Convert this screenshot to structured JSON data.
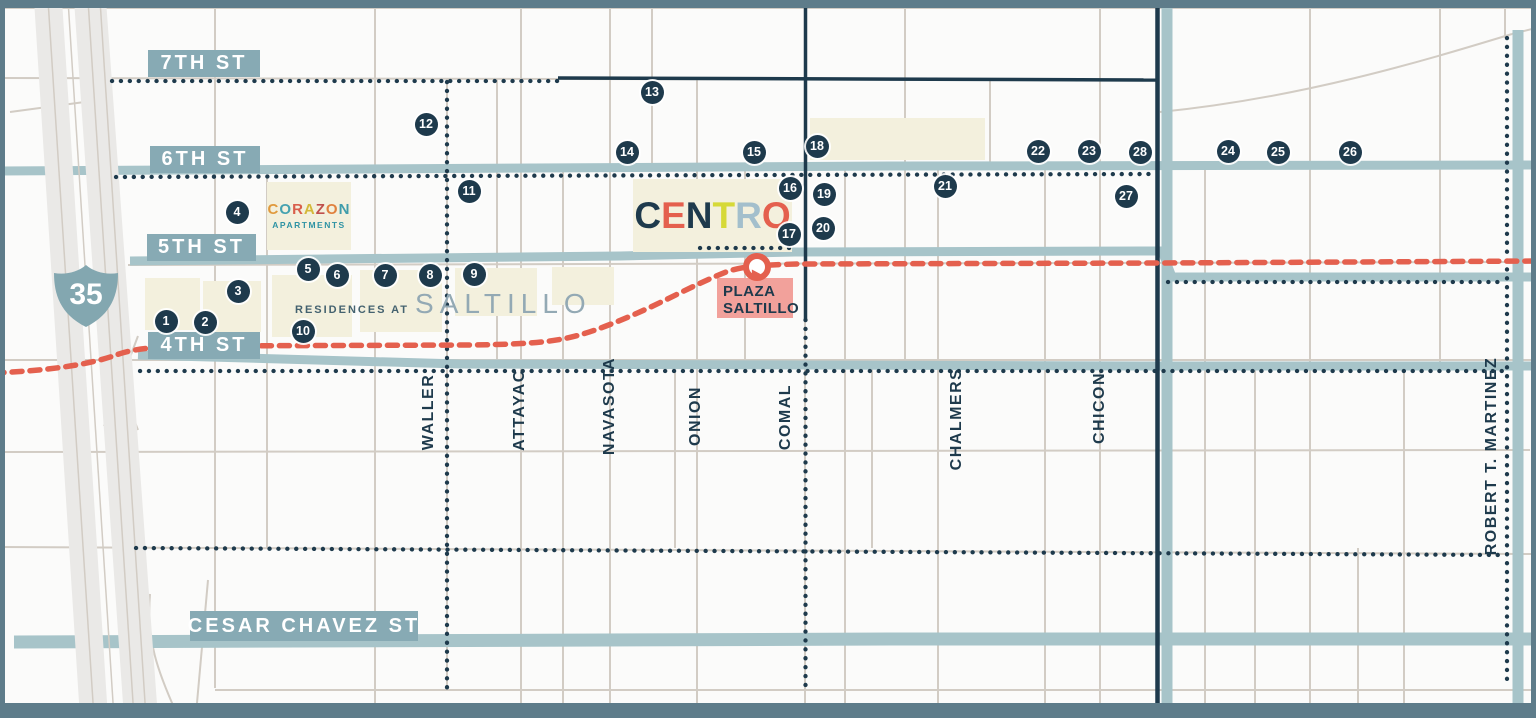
{
  "interstate_shield": {
    "number": "35"
  },
  "horizontal_streets": [
    {
      "id": "7th",
      "label": "7TH ST"
    },
    {
      "id": "6th",
      "label": "6TH ST"
    },
    {
      "id": "5th",
      "label": "5TH ST"
    },
    {
      "id": "4th",
      "label": "4TH ST"
    },
    {
      "id": "cesar_chavez",
      "label": "CESAR CHAVEZ ST"
    }
  ],
  "cross_streets": [
    {
      "label": "WALLER",
      "x": 429,
      "y": 412
    },
    {
      "label": "ATTAYAC",
      "x": 520,
      "y": 410
    },
    {
      "label": "NAVASOTA",
      "x": 610,
      "y": 406
    },
    {
      "label": "ONION",
      "x": 696,
      "y": 416
    },
    {
      "label": "COMAL",
      "x": 786,
      "y": 417
    },
    {
      "label": "CHALMERS",
      "x": 957,
      "y": 419
    },
    {
      "label": "CHICON",
      "x": 1100,
      "y": 408
    },
    {
      "label": "ROBERT T. MARTINEZ",
      "x": 1492,
      "y": 456
    }
  ],
  "landmarks": {
    "centro": {
      "name": "CENTRO"
    },
    "corazon_apartments": {
      "name": "CORAZON",
      "subtitle": "APARTMENTS"
    },
    "residences_at_saltillo": {
      "prefix": "RESIDENCES AT",
      "name": "SALTILLO"
    },
    "plaza_saltillo": {
      "line1": "PLAZA",
      "line2": "SALTILLO"
    }
  },
  "markers": [
    {
      "n": "1",
      "x": 166,
      "y": 321
    },
    {
      "n": "2",
      "x": 205,
      "y": 322
    },
    {
      "n": "3",
      "x": 238,
      "y": 291
    },
    {
      "n": "4",
      "x": 237,
      "y": 212
    },
    {
      "n": "5",
      "x": 308,
      "y": 269
    },
    {
      "n": "6",
      "x": 337,
      "y": 275
    },
    {
      "n": "7",
      "x": 385,
      "y": 275
    },
    {
      "n": "8",
      "x": 430,
      "y": 275
    },
    {
      "n": "9",
      "x": 474,
      "y": 274
    },
    {
      "n": "10",
      "x": 303,
      "y": 331
    },
    {
      "n": "11",
      "x": 469,
      "y": 191
    },
    {
      "n": "12",
      "x": 426,
      "y": 124
    },
    {
      "n": "13",
      "x": 652,
      "y": 92
    },
    {
      "n": "14",
      "x": 627,
      "y": 152
    },
    {
      "n": "15",
      "x": 754,
      "y": 152
    },
    {
      "n": "16",
      "x": 790,
      "y": 188
    },
    {
      "n": "17",
      "x": 789,
      "y": 234
    },
    {
      "n": "18",
      "x": 817,
      "y": 146
    },
    {
      "n": "19",
      "x": 824,
      "y": 194
    },
    {
      "n": "20",
      "x": 823,
      "y": 228
    },
    {
      "n": "21",
      "x": 945,
      "y": 186
    },
    {
      "n": "22",
      "x": 1038,
      "y": 151
    },
    {
      "n": "23",
      "x": 1089,
      "y": 151
    },
    {
      "n": "24",
      "x": 1228,
      "y": 151
    },
    {
      "n": "25",
      "x": 1278,
      "y": 152
    },
    {
      "n": "26",
      "x": 1350,
      "y": 152
    },
    {
      "n": "27",
      "x": 1126,
      "y": 196
    },
    {
      "n": "28",
      "x": 1140,
      "y": 152
    }
  ],
  "colors": {
    "navy": "#1e3a4c",
    "road_teal": "#a7c4c9",
    "badge_teal": "#87aab4",
    "rail_red": "#e4604e",
    "building_cream": "#f3f0dd",
    "plaza_pink": "#f2a19b",
    "frame": "#5e7c8a",
    "minor_road_gray": "#d2ccc4",
    "highway_gray": "#eae9e7"
  }
}
